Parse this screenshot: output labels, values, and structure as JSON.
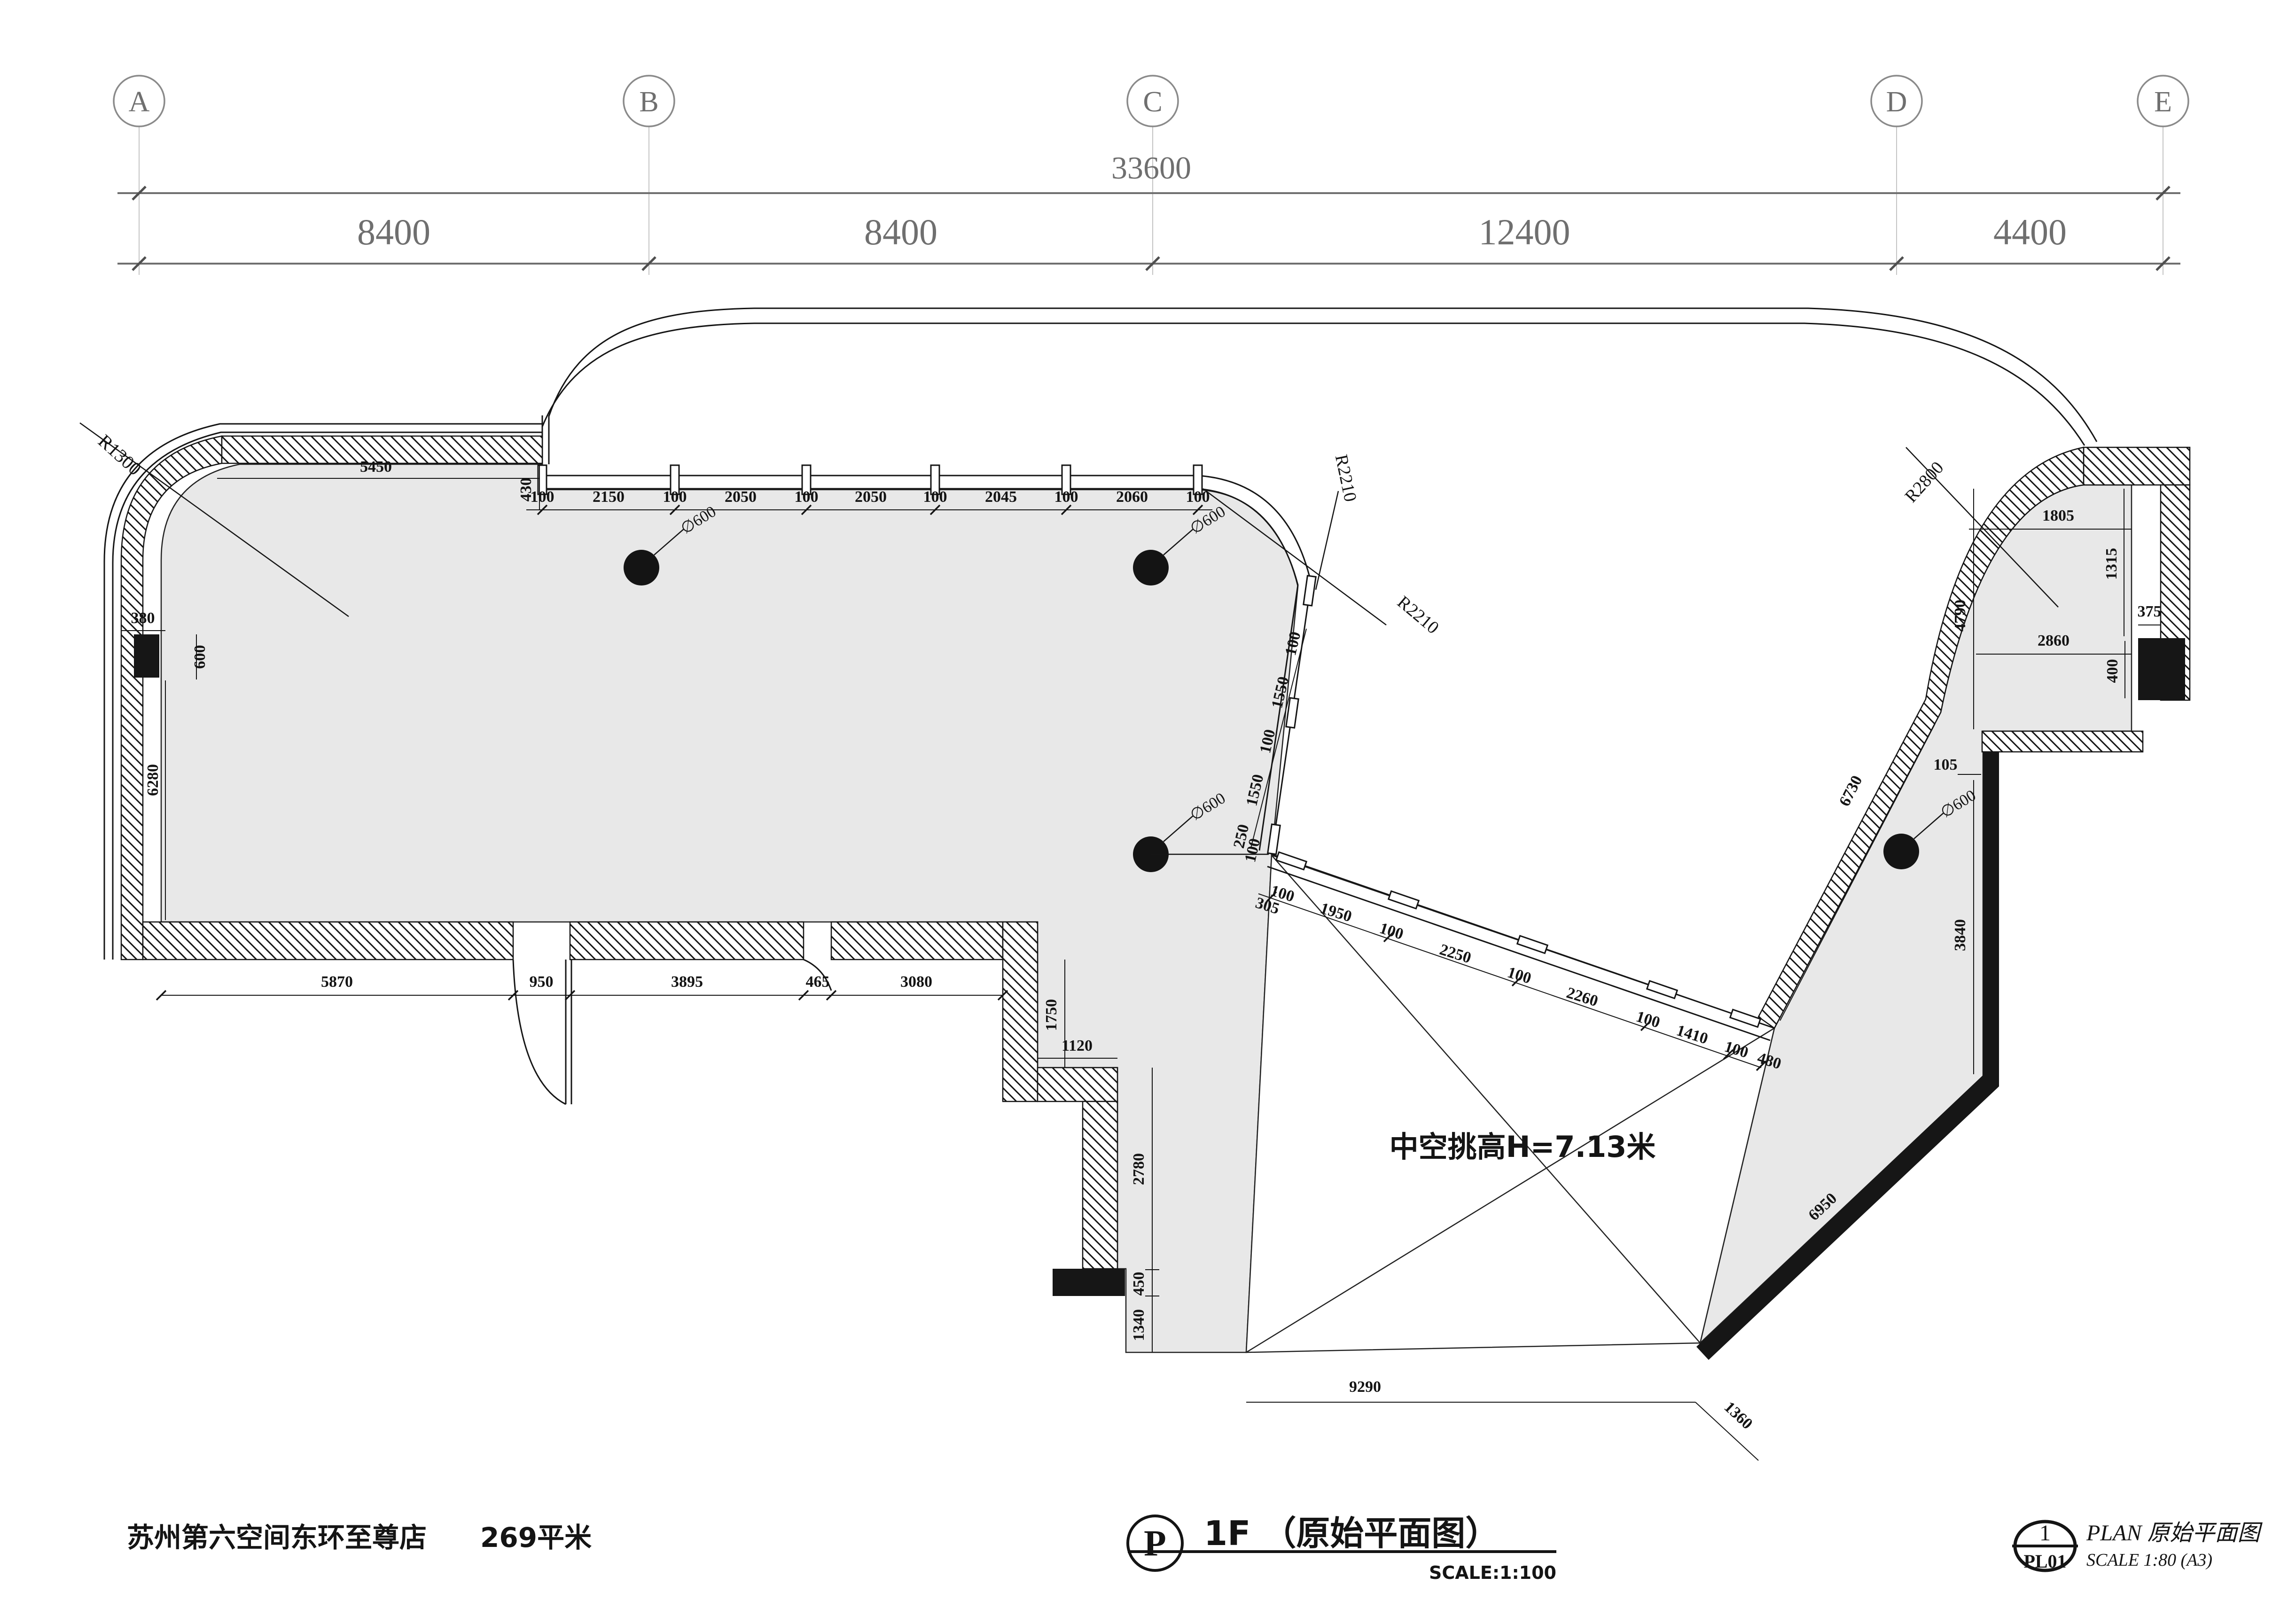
{
  "grid": {
    "bubbles": [
      "A",
      "B",
      "C",
      "D",
      "E"
    ],
    "total": "33600",
    "spans": [
      "8400",
      "8400",
      "12400",
      "4400"
    ]
  },
  "dims": {
    "top_left": {
      "d5450": "5450",
      "d430": "430",
      "r1300": "R1300",
      "d380": "380",
      "d600": "600",
      "d6280": "6280"
    },
    "top_chain": [
      "100",
      "2150",
      "100",
      "2050",
      "100",
      "2050",
      "100",
      "2045",
      "100",
      "2060",
      "100"
    ],
    "r2210_a": "R2210",
    "r2210_b": "R2210",
    "slant_chain": [
      "100",
      "1550",
      "100",
      "1550",
      "250",
      "100"
    ],
    "beam_chain": [
      "305",
      "100",
      "1950",
      "100",
      "2250",
      "100",
      "2260",
      "100",
      "1410",
      "100",
      "480"
    ],
    "bottom_chain": [
      "5870",
      "950",
      "3895",
      "465",
      "3080"
    ],
    "step_chain": [
      "1750",
      "1120",
      "2780",
      "450",
      "1340"
    ],
    "bottom_edge": [
      "9290",
      "1360"
    ],
    "right_top": {
      "r2800": "R2800",
      "d1805": "1805",
      "d1315": "1315",
      "d375": "375",
      "d2860": "2860",
      "d400": "400"
    },
    "right_side": {
      "d4790": "4790",
      "d105": "105",
      "d3840": "3840",
      "d6730": "6730",
      "d6950": "6950"
    },
    "columns": {
      "c1": "∅600",
      "c2": "∅600",
      "c3": "∅600",
      "c4": "∅600"
    }
  },
  "annotations": {
    "void": "中空挑高H=7.13米"
  },
  "titles": {
    "project": "苏州第六空间东环至尊店",
    "area": "269平米",
    "main_bubble": "P",
    "main": "1F （原始平面图）",
    "main_scale": "SCALE:1:100",
    "ref_num": "1",
    "ref_code": "PL01",
    "ref_title": "PLAN 原始平面图",
    "ref_scale": "SCALE 1:80 (A3)"
  },
  "colors": {
    "floor": "#e8e8e8",
    "line": "#151515",
    "grid": "#7d7d7d"
  }
}
